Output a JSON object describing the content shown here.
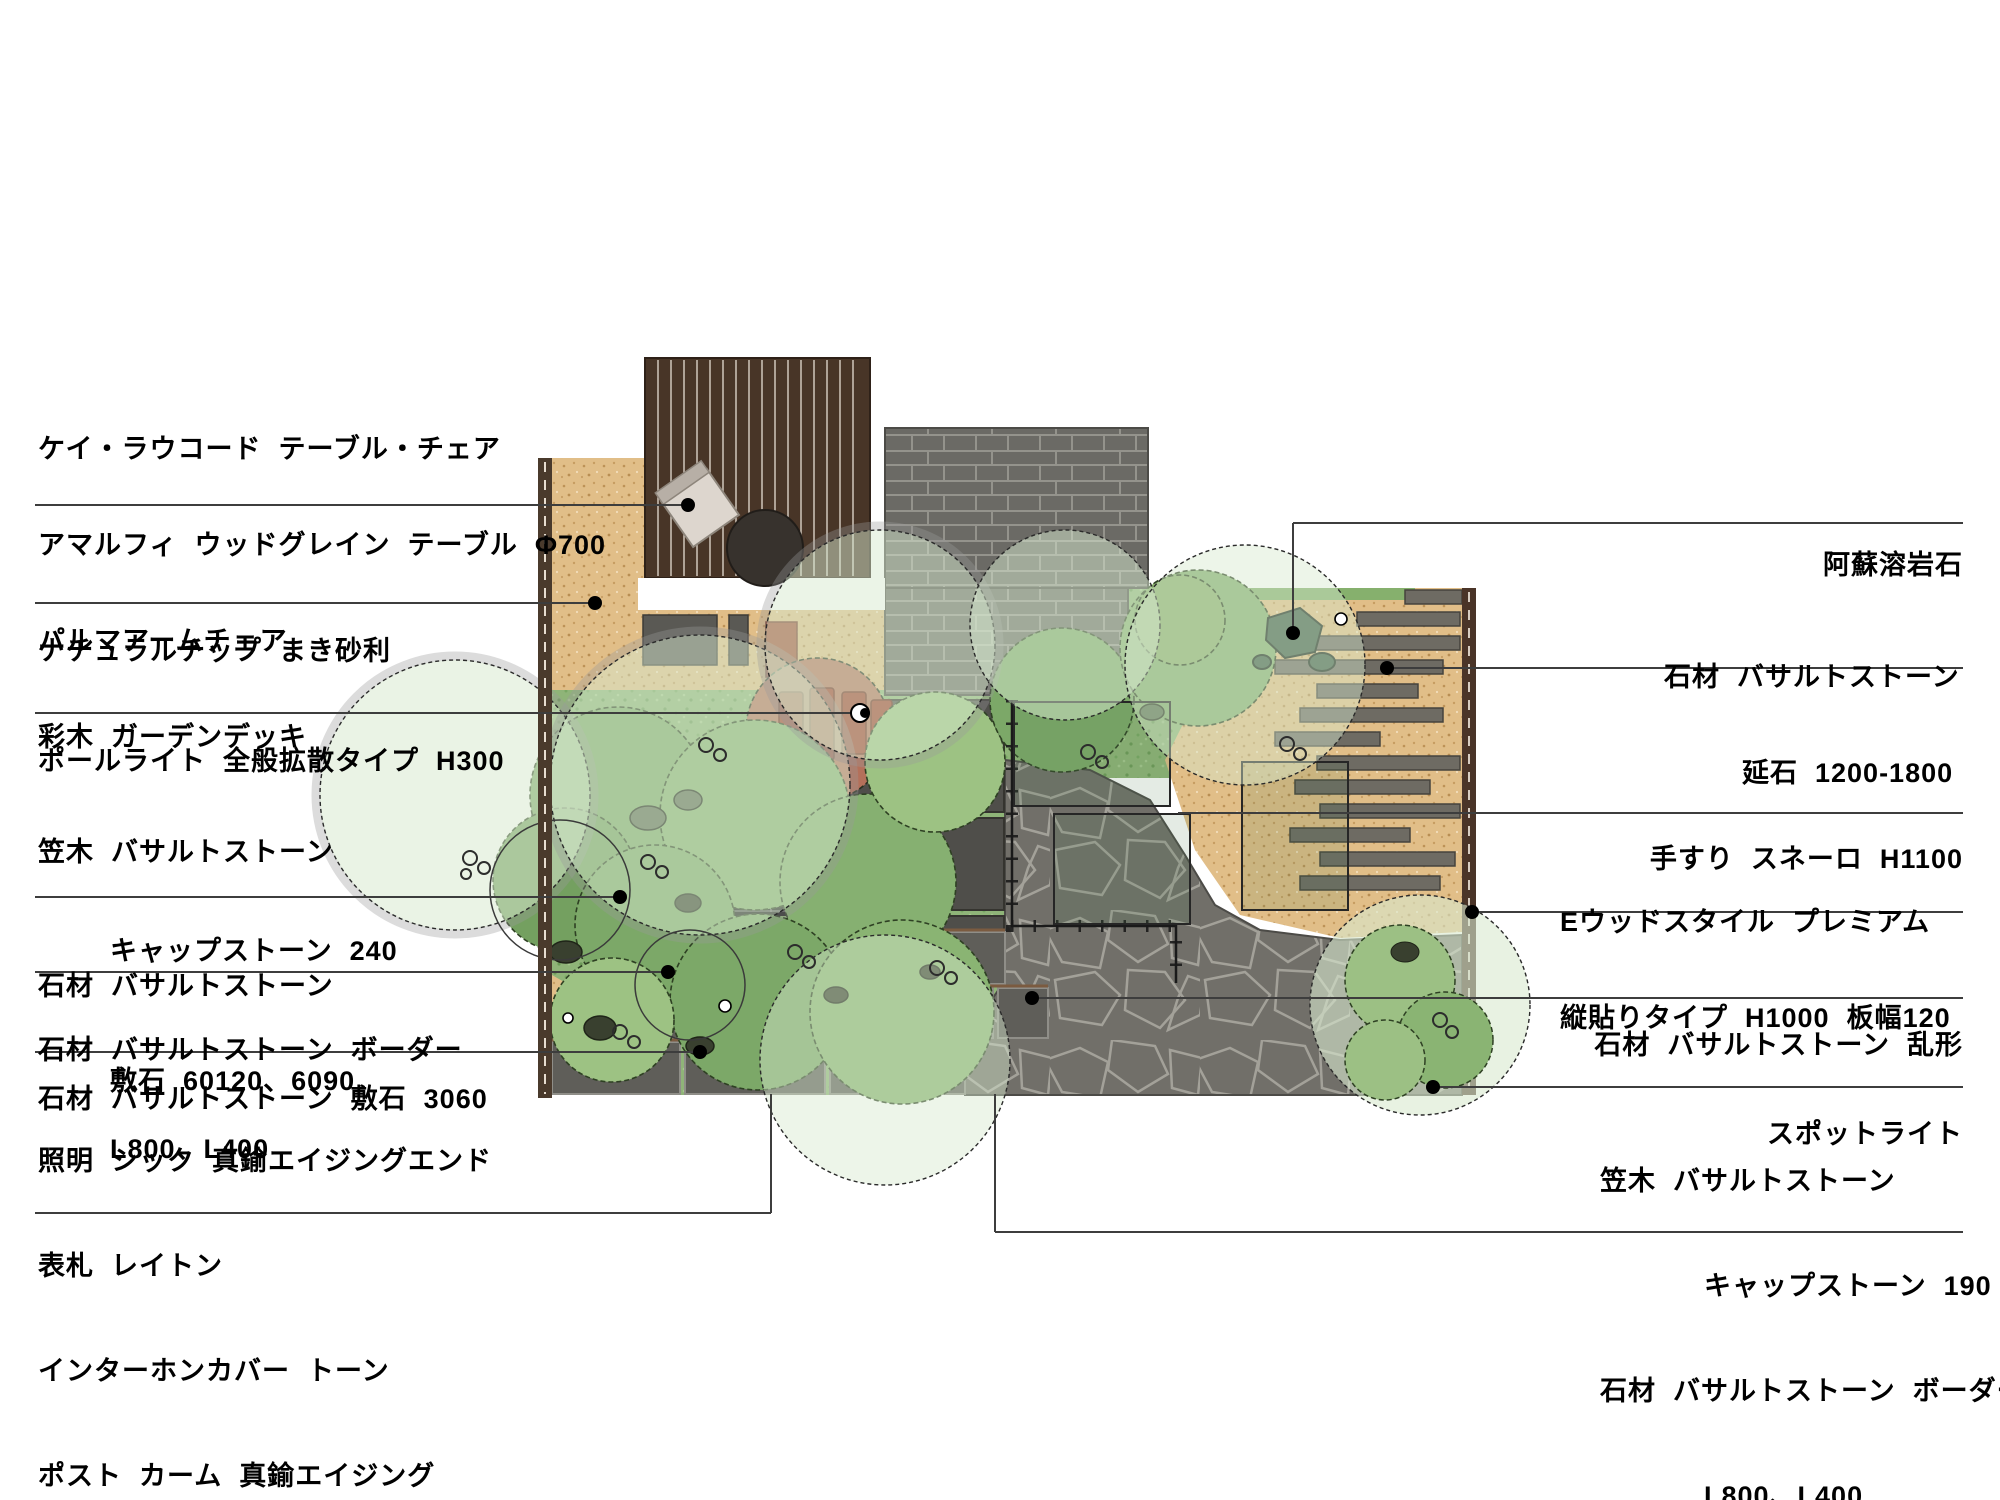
{
  "page": {
    "background": "#ffffff",
    "type": "garden-landscape-plan"
  },
  "colors": {
    "gravel_tan": "#e1be88",
    "deck_brown": "#483527",
    "planting_green": "#8fb478",
    "stone_gray": "#6b6a65",
    "leader_line": "#3d3d3d",
    "boundary_wall_brown": "#4a3a2c"
  },
  "labels": {
    "left": [
      {
        "lines": [
          "ケイ・ラウコード  テーブル・チェア",
          "アマルフィ  ウッドグレイン  テーブル  Φ700",
          "パルマアームチェア",
          "彩木  ガーデンデッキ"
        ]
      },
      {
        "lines": [
          "ナチュラルチップ  まき砂利"
        ]
      },
      {
        "lines": [
          "ポールライト  全般拡散タイプ  H300"
        ]
      },
      {
        "lines": [
          "笠木  バサルトストーン",
          "キャップストーン  240",
          "石材  バサルトストーン  ボーダー",
          "L800、L400"
        ]
      },
      {
        "lines": [
          "石材  バサルトストーン",
          "敷石  60120、6090"
        ]
      },
      {
        "lines": [
          "石材  バサルトストーン  敷石  3060"
        ]
      },
      {
        "lines": [
          "照明  シック  真鍮エイジングエンド",
          "表札  レイトン",
          "インターホンカバー  トーン",
          "ポスト  カーム  真鍮エイジング"
        ]
      }
    ],
    "right": [
      {
        "lines": [
          "阿蘇溶岩石"
        ]
      },
      {
        "lines": [
          "石材  バサルトストーン",
          "延石  1200-1800"
        ]
      },
      {
        "lines": [
          "手すり  スネーロ  H1100"
        ]
      },
      {
        "lines": [
          "Eウッドスタイル  プレミアム",
          "縦貼りタイプ  H1000  板幅120"
        ]
      },
      {
        "lines": [
          "石材  バサルトストーン  乱形"
        ]
      },
      {
        "lines": [
          "スポットライト"
        ]
      },
      {
        "lines": [
          "笠木  バサルトストーン",
          "キャップストーン  190",
          "石材  バサルトストーン  ボーダー",
          "L800、L400"
        ]
      }
    ]
  },
  "plan_features": [
    "wood-deck",
    "deck-table",
    "deck-chair",
    "natural-chip-gravel",
    "boundary-wall",
    "basalt-brick-wall",
    "planting-bed",
    "red-paver-circle",
    "nobeishi-long-stones",
    "flagstone-paving",
    "stone-steps",
    "capped-wall",
    "handrail",
    "wood-fence",
    "pole-light",
    "spot-light",
    "lava-rocks",
    "shrubs"
  ]
}
